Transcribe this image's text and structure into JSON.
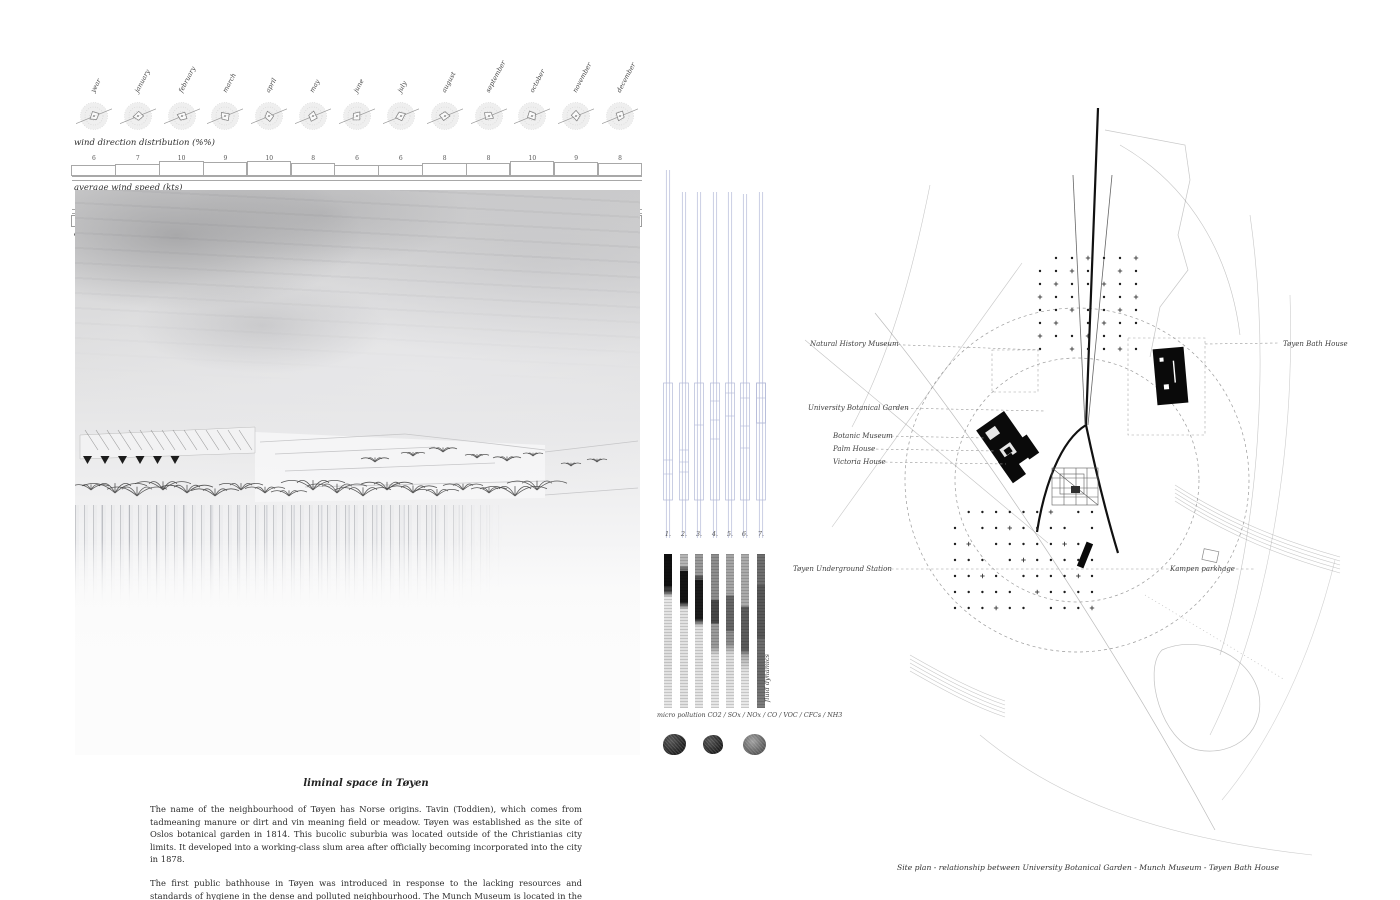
{
  "board": {
    "background": "#ffffff",
    "tube_blue": "#b3b9d8",
    "ink": "#333333"
  },
  "climate": {
    "months": [
      "year",
      "january",
      "february",
      "march",
      "april",
      "may",
      "june",
      "july",
      "august",
      "september",
      "october",
      "november",
      "december"
    ],
    "wind_direction_label": "wind direction distribution (%%)",
    "wind_speed_label": "average wind speed (kts)",
    "wind_speed_values": [
      "6",
      "7",
      "10",
      "9",
      "10",
      "8",
      "6",
      "6",
      "8",
      "8",
      "10",
      "9",
      "8"
    ],
    "temperature_label": "average air temperature (°C)",
    "temperature_top_values": [
      "6",
      "6",
      "6",
      "7",
      "7",
      "6",
      "6",
      "6",
      "6",
      "6",
      "6",
      "6",
      "6"
    ],
    "temperature_values": [
      "6",
      "-4",
      "-3",
      "1",
      "5",
      "11",
      "17",
      "18",
      "17",
      "12",
      "7",
      "1",
      "-2"
    ]
  },
  "samples": {
    "numbers": [
      "1.",
      "2.",
      "3.",
      "4.",
      "5.",
      "6.",
      "7."
    ],
    "caption": "micro pollution CO2 / SOx / NOx / CO / VOC / CFCs / NH3",
    "side_label": "fluid dynamics"
  },
  "essay": {
    "title": "liminal space in Tøyen",
    "paragraphs": [
      "The name of the neighbourhood of Tøyen has Norse origins. Tavin (Toddien), which comes from tadmeaning manure or dirt and vin meaning field or meadow. Tøyen was established as the site of Oslos botanical garden in 1814. This bucolic suburbia was located outside of the Christianias city limits. It developed into a working-class slum area after officially becoming incorporated into the city in 1878.",
      "The first public bathhouse in Tøyen was introduced in response to the lacking resources and standards of hygiene in the dense and polluted neighbourhood. The Munch Museum is located in the lungs of Tøyen, at the intersection of the last residual Bath House and the Botanical Gardens."
    ]
  },
  "siteplan": {
    "labels": {
      "natural_history_museum": "Natural History Museum",
      "toyen_bath_house": "Tøyen Bath House",
      "university_botanical_garden": "University Botanical Garden",
      "botanic_museum": "Botanic Museum",
      "palm_house": "Palm House",
      "victoria_house": "Victoria House",
      "toyen_underground_station": "Tøyen Underground Station",
      "kampen_parkhage": "Kampen parkhage"
    },
    "caption": "Site plan - relationship between University Botanical Garden - Munch Museum - Tøyen Bath House"
  }
}
